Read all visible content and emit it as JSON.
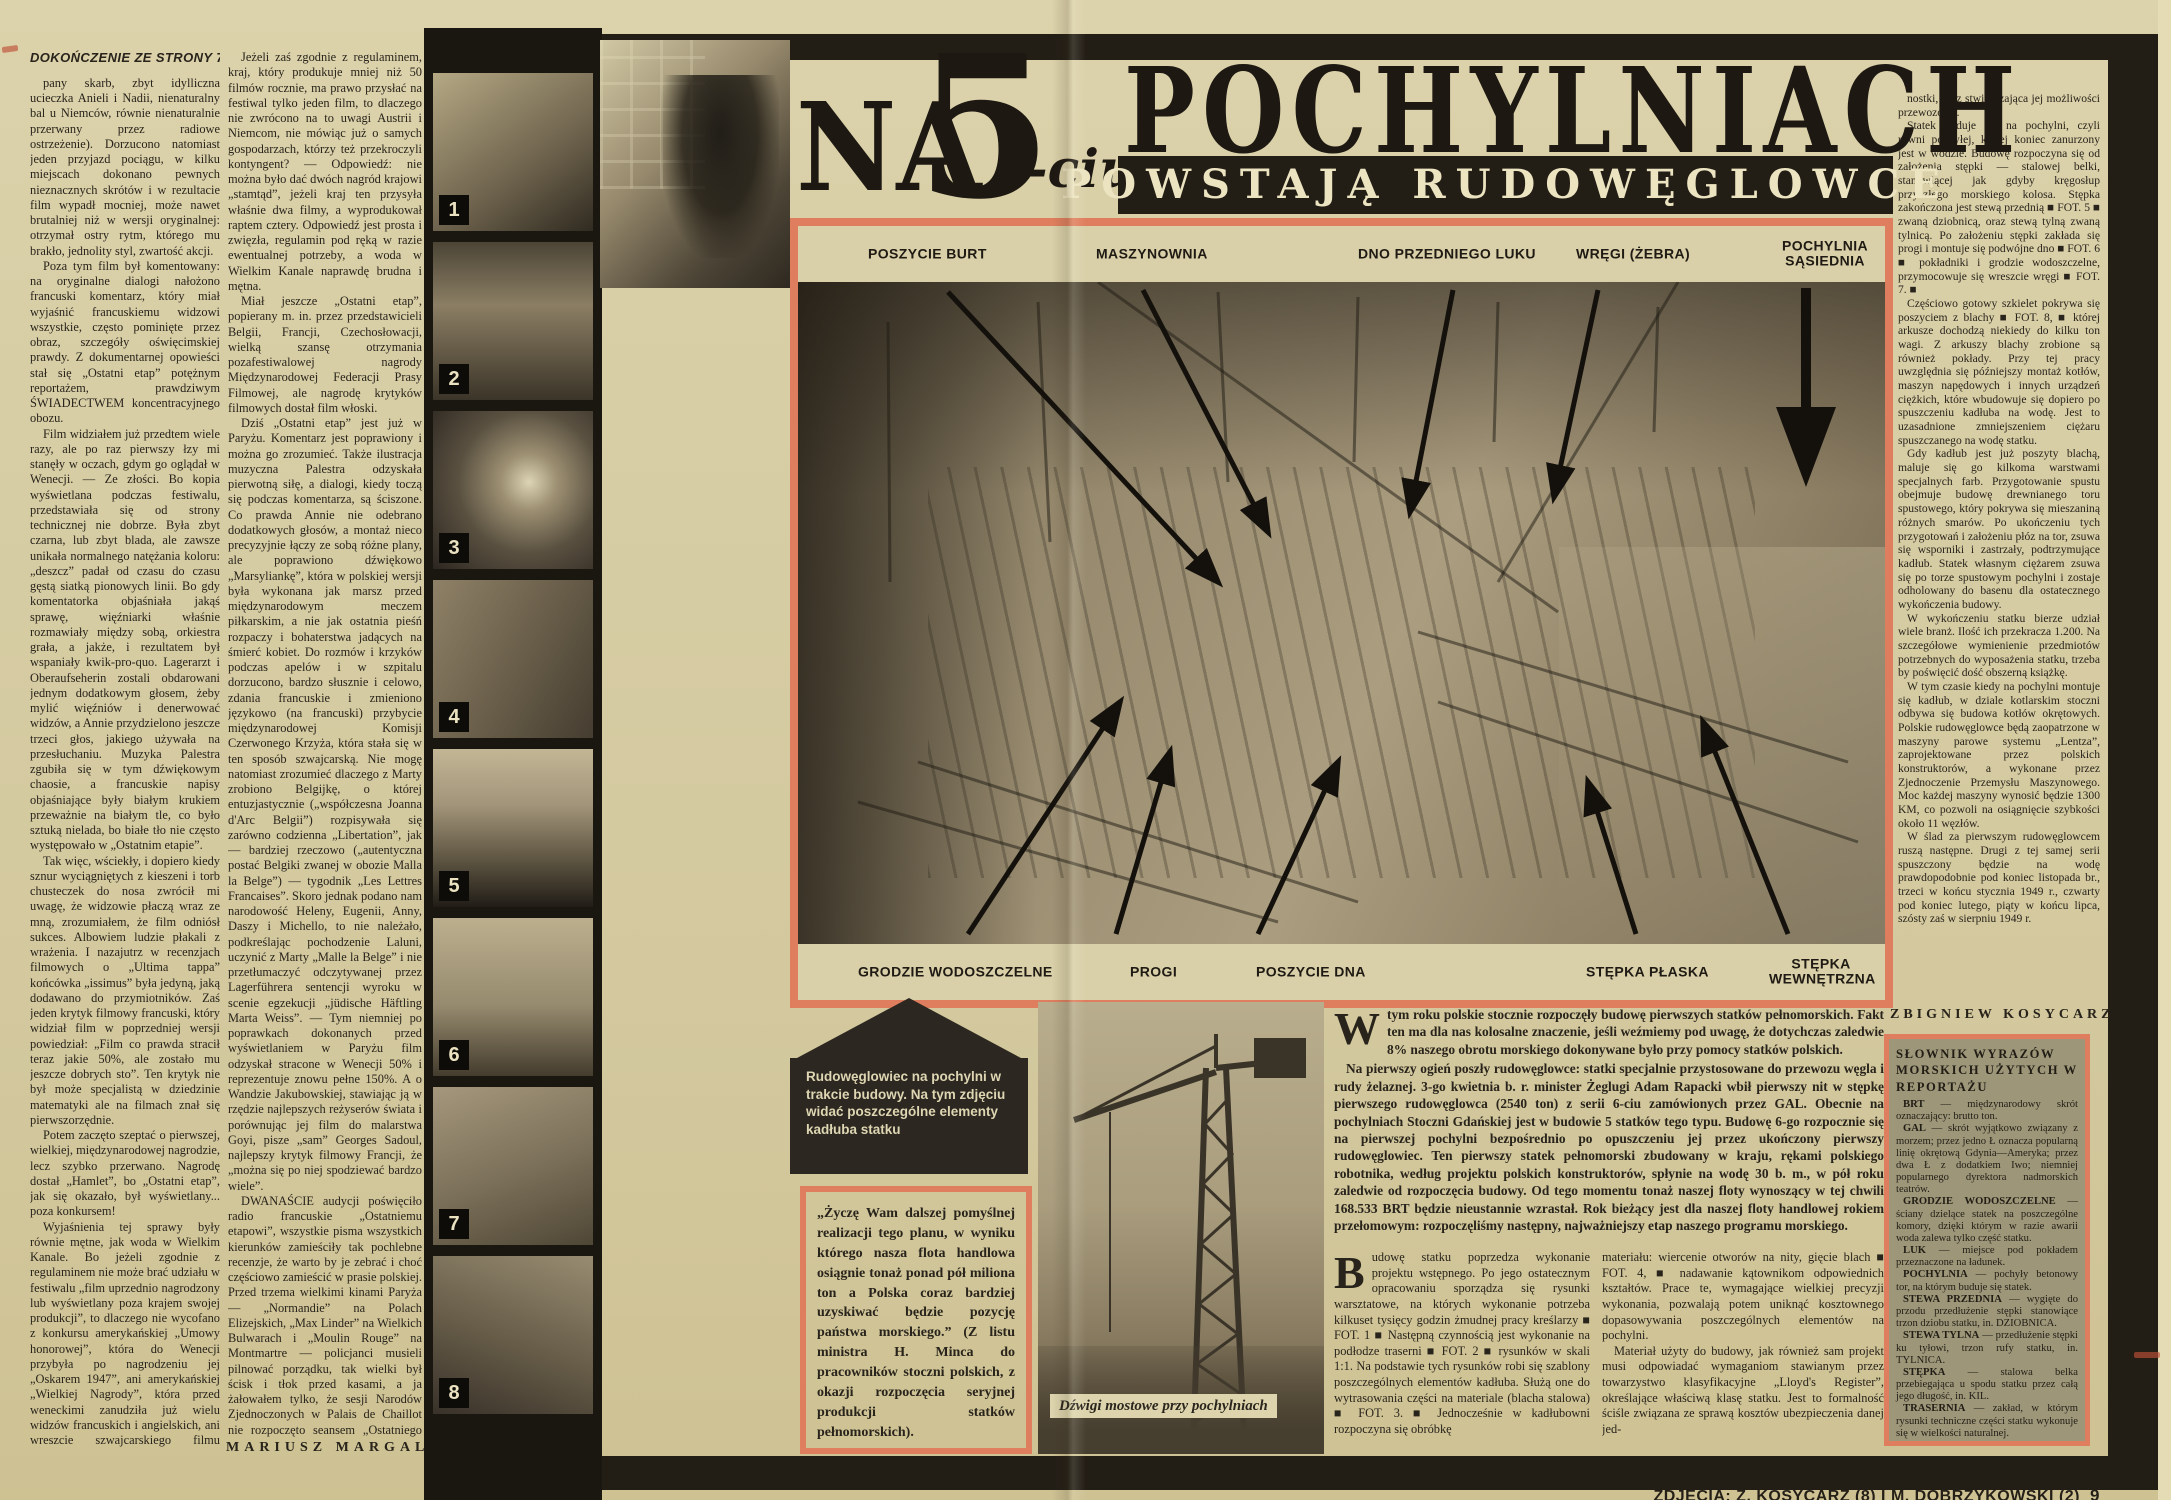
{
  "colors": {
    "paper": "#d6cca3",
    "ink": "#28231b",
    "accent_salmon": "#df7e5e",
    "bar_black": "#221d15",
    "dict_bg": "#9d9679"
  },
  "headline": {
    "na": "NA",
    "five": "5",
    "ciu": "-ciu",
    "word": "POCHYLNIACH",
    "subtitle": "POWSTAJĄ RUDOWĘGLOWCE"
  },
  "left_article": {
    "continuation_header": "DOKOŃCZENIE ZE STRONY 7-MEJ",
    "column1_paragraphs": [
      "pany skarb, zbyt idylliczna ucieczka Anieli i Nadii, nienaturalny bal u Niemców, równie nienaturalnie przerwany przez radiowe ostrzeżenie). Dorzucono natomiast jeden przyjazd pociągu, w kilku miejscach dokonano pewnych nieznacznych skrótów i w rezultacie film wypadł mocniej, może nawet brutalniej niż w wersji oryginalnej: otrzymał ostry rytm, którego mu brakło, jednolity styl, zwartość akcji.",
      "Poza tym film był komentowany: na oryginalne dialogi nałożono francuski komentarz, który miał wyjaśnić francuskiemu widzowi wszystkie, często pominięte przez obraz, szczegóły oświęcimskiej prawdy. Z dokumentarnej opowieści stał się „Ostatni etap” potężnym reportażem, prawdziwym ŚWIADECTWEM koncentracyjnego obozu.",
      "Film widziałem już przedtem wiele razy, ale po raz pierwszy łzy mi stanęły w oczach, gdym go oglądał w Wenecji. — Ze złości. Bo kopia wyświetlana podczas festiwalu, przedstawiała się od strony technicznej nie dobrze. Była zbyt czarna, lub zbyt blada, ale zawsze unikała normalnego natężania koloru: „deszcz” padał od czasu do czasu gęstą siatką pionowych linii. Bo gdy komentatorka objaśniała jakąś sprawę, więźniarki właśnie rozmawiały między sobą, orkiestra grała, a jakże, i rezultatem był wspaniały kwik-pro-quo. Lagerarzt i Oberaufseherin zostali obdarowani jednym dodatkowym głosem, żeby mylić więźniów i denerwować widzów, a Annie przydzielono jeszcze trzeci głos, jakiego używała na przesłuchaniu. Muzyka Palestra zgubiła się w tym dźwiękowym chaosie, a francuskie napisy objaśniające były białym krukiem przeważnie na białym tle, co było sztuką nielada, bo białe tło nie często występowało w „Ostatnim etapie”.",
      "Tak więc, wściekły, i dopiero kiedy sznur wyciągniętych z kieszeni i torb chusteczek do nosa zwrócił mi uwagę, że widzowie płaczą wraz ze mną, zrozumiałem, że film odniósł sukces. Albowiem ludzie płakali z wrażenia. I nazajutrz w recenzjach filmowych o „Ultima tappa” końcówka „issimus” była jedyną, jaką dodawano do przymiotników. Zaś jeden krytyk filmowy francuski, który widział film w poprzedniej wersji powiedział: „Film co prawda stracił teraz jakie 50%, ale zostało mu jeszcze dobrych sto”. Ten krytyk nie był może specjalistą w dziedzinie matematyki ale na filmach znał się pierwszorzędnie.",
      "Potem zaczęto szeptać o pierwszej, wielkiej, międzynarodowej nagrodzie, lecz szybko przerwano. Nagrodę dostał „Hamlet”, bo „Ostatni etap”, jak się okazało, był wyświetlany... poza konkursem!",
      "Wyjaśnienia tej sprawy były równie mętne, jak woda w Wielkim Kanale. Bo jeżeli zgodnie z regulaminem nie może brać udziału w festiwalu „film uprzednio nagrodzony lub wyświetlany poza krajem swojej produkcji”, to dlaczego nie wycofano z konkursu amerykańskiej „Umowy honorowej”, która do Wenecji przybyła po nagrodzeniu jej „Oskarem 1947”, ani amerykańskiej „Wielkiej Nagrody”, która przed weneckimi zanudziła już wielu widzów francuskich i angielskich, ani wreszcie szwajcarskiego filmu „Napiętnowani”, który był wyświetlany w Mariańskich Łaźniach?"
    ],
    "column2_paragraphs": [
      "Jeżeli zaś zgodnie z regulaminem, kraj, który produkuje mniej niż 50 filmów rocznie, ma prawo przysłać na festiwal tylko jeden film, to dlaczego nie zwrócono na to uwagi Austrii i Niemcom, nie mówiąc już o samych gospodarzach, którzy też przekroczyli kontyngent? — Odpowiedź: nie można było dać dwóch nagród krajowi „stamtąd”, jeżeli kraj ten przysyła właśnie dwa filmy, a wyprodukował raptem cztery. Odpowiedź jest prosta i zwięzła, regulamin pod ręką w razie ewentualnej potrzeby, a woda w Wielkim Kanale naprawdę brudna i mętna.",
      "Miał jeszcze „Ostatni etap”, popierany m. in. przez przedstawicieli Belgii, Francji, Czechosłowacji, wielką szansę otrzymania pozafestiwalowej nagrody Międzynarodowej Federacji Prasy Filmowej, ale nagrodę krytyków filmowych dostał film włoski.",
      "Dziś „Ostatni etap” jest już w Paryżu. Komentarz jest poprawiony i można go zrozumieć. Także ilustracja muzyczna Palestra odzyskała pierwotną siłę, a dialogi, kiedy toczą się podczas komentarza, są ściszone. Co prawda Annie nie odebrano dodatkowych głosów, a montaż nieco precyzyjnie łączy ze sobą różne plany, ale poprawiono dźwiękowo „Marsyliankę”, która w polskiej wersji była wykonana jak marsz przed międzynarodowym meczem piłkarskim, a nie jak ostatnia pieśń rozpaczy i bohaterstwa jadących na śmierć kobiet. Do rozmów i krzyków podczas apelów i w szpitalu dorzucono, bardzo słusznie i celowo, zdania francuskie i zmieniono językowo (na francuski) przybycie międzynarodowej Komisji Czerwonego Krzyża, która stała się w ten sposób szwajcarską. Nie mogę natomiast zrozumieć dlaczego z Marty zrobiono Belgijkę, o której entuzjastycznie („współczesna Joanna d'Arc Belgii”) rozpisywała się zarówno codzienna „Libertation”, jak — bardziej rzeczowo („autentyczna postać Belgiki zwanej w obozie Malla la Belge”) — tygodnik „Les Lettres Francaises”. Skoro jednak podano nam narodowość Heleny, Eugenii, Anny, Daszy i Michello, to nie należało, podkreślając pochodzenie Laluni, uczynić z Marty „Malle la Belge” i nie przetłumaczyć odczytywanej przez Lagerführera sentencji wyroku w scenie egzekucji „jüdische Häftling Marta Weiss”. — Tym niemniej po poprawkach dokonanych przed wyświetlaniem w Paryżu film odzyskał stracone w Wenecji 50% i reprezentuje znowu pełne 150%. A o Wandzie Jakubowskiej, stawiając ją w rzędzie najlepszych reżyserów świata i porównując jej film do malarstwa Goyi, pisze „sam” Georges Sadoul, najlepszy krytyk filmowy Francji, że „można się po niej spodziewać bardzo wiele”.",
      "DWANAŚCIE audycji poświęciło radio francuskie „Ostatniemu etapowi”, wszystkie pisma wszystkich kierunków zamieściły tak pochlebne recenzje, że warto by je zebrać i choć częściowo zamieścić w prasie polskiej. Przed trzema wielkimi kinami Paryża — „Normandie” na Polach Elizejskich, „Max Linder” na Wielkich Bulwarach i „Moulin Rouge” na Montmartre — policjanci musieli pilnować porządku, tak wielki był ścisk i tłok przed kasami, a ja żałowałem tylko, że sesji Narodów Zjednoczonych w Palais de Chaillot nie rozpoczęto seansem „Ostatniego etapu”. Przynajmniej dla niektórych delegatów."
    ],
    "signature": "MARIUSZ MARGAL"
  },
  "photo_strip": {
    "photos": [
      {
        "num": "1"
      },
      {
        "num": "2"
      },
      {
        "num": "3"
      },
      {
        "num": "4"
      },
      {
        "num": "5"
      },
      {
        "num": "6"
      },
      {
        "num": "7"
      },
      {
        "num": "8"
      }
    ]
  },
  "main_photo": {
    "top_labels": [
      "POSZYCIE BURT",
      "MASZYNOWNIA",
      "DNO PRZEDNIEGO LUKU",
      "WRĘGI (ŻEBRA)",
      "POCHYLNIA SĄSIEDNIA"
    ],
    "bottom_labels": [
      "GRODZIE WODOSZCZELNE",
      "PROGI",
      "POSZYCIE DNA",
      "STĘPKA PŁASKA",
      "STĘPKA WEWNĘTRZNA"
    ]
  },
  "arrow_caption": "Rudowęglowiec na pochylni w trakcie budowy. Na tym zdjęciu widać poszczególne elementy kadłuba statku",
  "quote_box": "„Życzę Wam dalszej pomyślnej realizacji tego planu, w wyniku którego nasza flota handlowa osiągnie tonaż ponad pół miliona ton a Polska coraz bardziej uzyskiwać będzie pozycję państwa morskiego.” (Z listu ministra H. Minca do pracowników stoczni polskich, z okazji rozpoczęcia seryjnej produkcji statków pełnomorskich).",
  "crane_caption": "Dźwigi mostowe przy pochylniach",
  "intro": {
    "dropcap": "W",
    "p1_rest": "tym roku polskie stocznie rozpoczęły budowę pierwszych statków pełnomorskich. Fakt ten ma dla nas kolosalne znaczenie, jeśli weźmiemy pod uwagę, że dotychczas zaledwie 8% naszego obrotu morskiego dokonywane było przy pomocy statków polskich.",
    "p2": "Na pierwszy ogień poszły rudowęglowce: statki specjalnie przystosowane do przewozu węgla i rudy żelaznej. 3-go kwietnia b. r. minister Żeglugi Adam Rapacki wbił pierwszy nit w stępkę pierwszego rudowęglowca (2540 ton) z serii 6-ciu zamówionych przez GAL. Obecnie na pochylniach Stoczni Gdańskiej jest w budowie 5 statków tego typu. Budowę 6-go rozpocznie się na pierwszej pochylni bezpośrednio po opuszczeniu jej przez ukończony pierwszy rudowęglowiec. Ten pierwszy statek pełnomorski zbudowany w kraju, rękami polskiego robotnika, według projektu polskich konstruktorów, spłynie na wodę 30 b. m., w pół roku zaledwie od rozpoczęcia budowy. Od tego momentu tonaż naszej floty wynoszący w tej chwili 168.533 BRT będzie nieustannie wzrastał. Rok bieżący jest dla naszej floty handlowej rokiem przełomowym: rozpoczęliśmy następny, najważniejszy etap naszego programu morskiego."
  },
  "build_columns": {
    "colA_dropcap": "B",
    "colA_rest": "udowę statku poprzedza wykonanie projektu wstępnego. Po jego ostatecznym opracowaniu sporządza się rysunki warsztatowe, na których wykonanie potrzeba kilkuset tysięcy godzin żmudnej pracy kreślarzy ■ FOT. 1 ■ Następną czynnością jest wykonanie na podłodze traserni ■ FOT. 2 ■ rysunków w skali 1:1. Na podstawie tych rysunków robi się szablony poszczególnych elementów kadłuba. Służą one do wytrasowania części na materiale (blacha stalowa) ■ FOT. 3. ■ Jednocześnie w kadłubowni rozpoczyna się obróbkę",
    "colB_paragraphs": [
      "materiału: wiercenie otworów na nity, gięcie blach ■ FOT. 4, ■ nadawanie kątownikom odpowiednich kształtów. Prace te, wymagające wielkiej precyzji wykonania, pozwalają potem uniknąć kosztownego dopasowywania poszczególnych elementów na pochylni.",
      "Materiał użyty do budowy, jak również sam projekt musi odpowiadać wymaganiom stawianym przez towarzystwo klasyfikacyjne „Lloyd's Register”, określające właściwą klasę statku. Jest to formalność ściśle związana ze sprawą kosztów ubezpieczenia danej jed-"
    ]
  },
  "right_column": {
    "paragraphs": [
      "nostki, oraz stwierdzająca jej możliwości przewozowe.",
      "Statek buduje się na pochylni, czyli równi pochyłej, której koniec zanurzony jest w wodzie. Budowę rozpoczyna się od założenia stępki — stalowej belki, stanowiącej jak gdyby kręgosłup przyszłego morskiego kolosa. Stępka zakończona jest stewą przednią ■ FOT. 5 ■ zwaną dziobnicą, oraz stewą tylną zwaną tylnicą. Po założeniu stępki zakłada się progi i montuje się podwójne dno ■ FOT. 6 ■ pokładniki i grodzie wodoszczelne, przymocowuje się wreszcie wręgi ■ FOT. 7. ■",
      "Częściowo gotowy szkielet pokrywa się poszyciem z blachy ■ FOT. 8, ■ której arkusze dochodzą niekiedy do kilku ton wagi. Z arkuszy blachy zrobione są również pokłady. Przy tej pracy uwzględnia się późniejszy montaż kotłów, maszyn napędowych i innych urządzeń ciężkich, które wbudowuje się dopiero po spuszczeniu kadłuba na wodę. Jest to uzasadnione zmniejszeniem ciężaru spuszczanego na wodę statku.",
      "Gdy kadłub jest już poszyty blachą, maluje się go kilkoma warstwami specjalnych farb. Przygotowanie spustu obejmuje budowę drewnianego toru spustowego, który pokrywa się mieszaniną różnych smarów. Po ukończeniu tych przygotowań i założeniu płóz na tor, zsuwa się wsporniki i zastrzały, podtrzymujące kadłub. Statek własnym ciężarem zsuwa się po torze spustowym pochylni i zostaje odholowany do basenu dla ostatecznego wykończenia budowy.",
      "W wykończeniu statku bierze udział wiele branż. Ilość ich przekracza 1.200. Na szczegółowe wymienienie przedmiotów potrzebnych do wyposażenia statku, trzeba by poświęcić dość obszerną książkę.",
      "W tym czasie kiedy na pochylni montuje się kadłub, w dziale kotlarskim stoczni odbywa się budowa kotłów okrętowych. Polskie rudowęglowce będą zaopatrzone w maszyny parowe systemu „Lentza”, zaprojektowane przez polskich konstruktorów, a wykonane przez Zjednoczenie Przemysłu Maszynowego. Moc każdej maszyny wynosić będzie 1300 KM, co pozwoli na osiągnięcie szybkości około 11 węzłów.",
      "W ślad za pierwszym rudowęglowcem ruszą następne. Drugi z tej samej serii spuszczony będzie na wodę prawdopodobnie pod koniec listopada br., trzeci w końcu stycznia 1949 r., czwarty pod koniec lutego, piąty w końcu lipca, szósty zaś w sierpniu 1949 r."
    ],
    "signature": "ZBIGNIEW KOSYCARZ"
  },
  "dictionary": {
    "title": "SŁOWNIK WYRAZÓW MORSKICH UŻYTYCH W REPORTAŻU",
    "entries": [
      {
        "term": "BRT",
        "def": "— międzynarodowy skrót oznaczający: brutto ton."
      },
      {
        "term": "GAL",
        "def": "— skrót wyjątkowo związany z morzem; przez jedno Ł oznacza popularną linię okrętową Gdynia—Ameryka; przez dwa Ł z dodatkiem Iwo; niemniej popularnego dyrektora nadmorskich teatrów."
      },
      {
        "term": "GRODZIE WODOSZCZELNE",
        "def": "— ściany dzielące statek na poszczególne komory, dzięki którym w razie awarii woda zalewa tylko część statku."
      },
      {
        "term": "LUK",
        "def": "— miejsce pod pokładem przeznaczone na ładunek."
      },
      {
        "term": "POCHYLNIA",
        "def": "— pochyły betonowy tor, na którym buduje się statek."
      },
      {
        "term": "STEWA PRZEDNIA",
        "def": "— wygięte do przodu przedłużenie stępki stanowiące trzon dziobu statku, in. DZIOBNICA."
      },
      {
        "term": "STEWA TYLNA",
        "def": "— przedłużenie stępki ku tyłowi, trzon rufy statku, in. TYLNICA."
      },
      {
        "term": "STĘPKA",
        "def": "— stalowa belka przebiegająca u spodu statku przez całą jego długość, in. KIL."
      },
      {
        "term": "TRASERNIA",
        "def": "— zakład, w którym rysunki techniczne części statku wykonuje się w wielkości naturalnej."
      },
      {
        "term": "WĘZEŁ MORSKI",
        "def": "— jednostka określająca szybkość statku w milach na godzinę."
      },
      {
        "term": "WRĘGA",
        "def": "— boczne żebro kadłuba."
      }
    ]
  },
  "credit": "ZDJĘCIA: Z. KOSYCARZ (8) I M. DOBRZYKOWSKI (2)",
  "page_number": "9"
}
